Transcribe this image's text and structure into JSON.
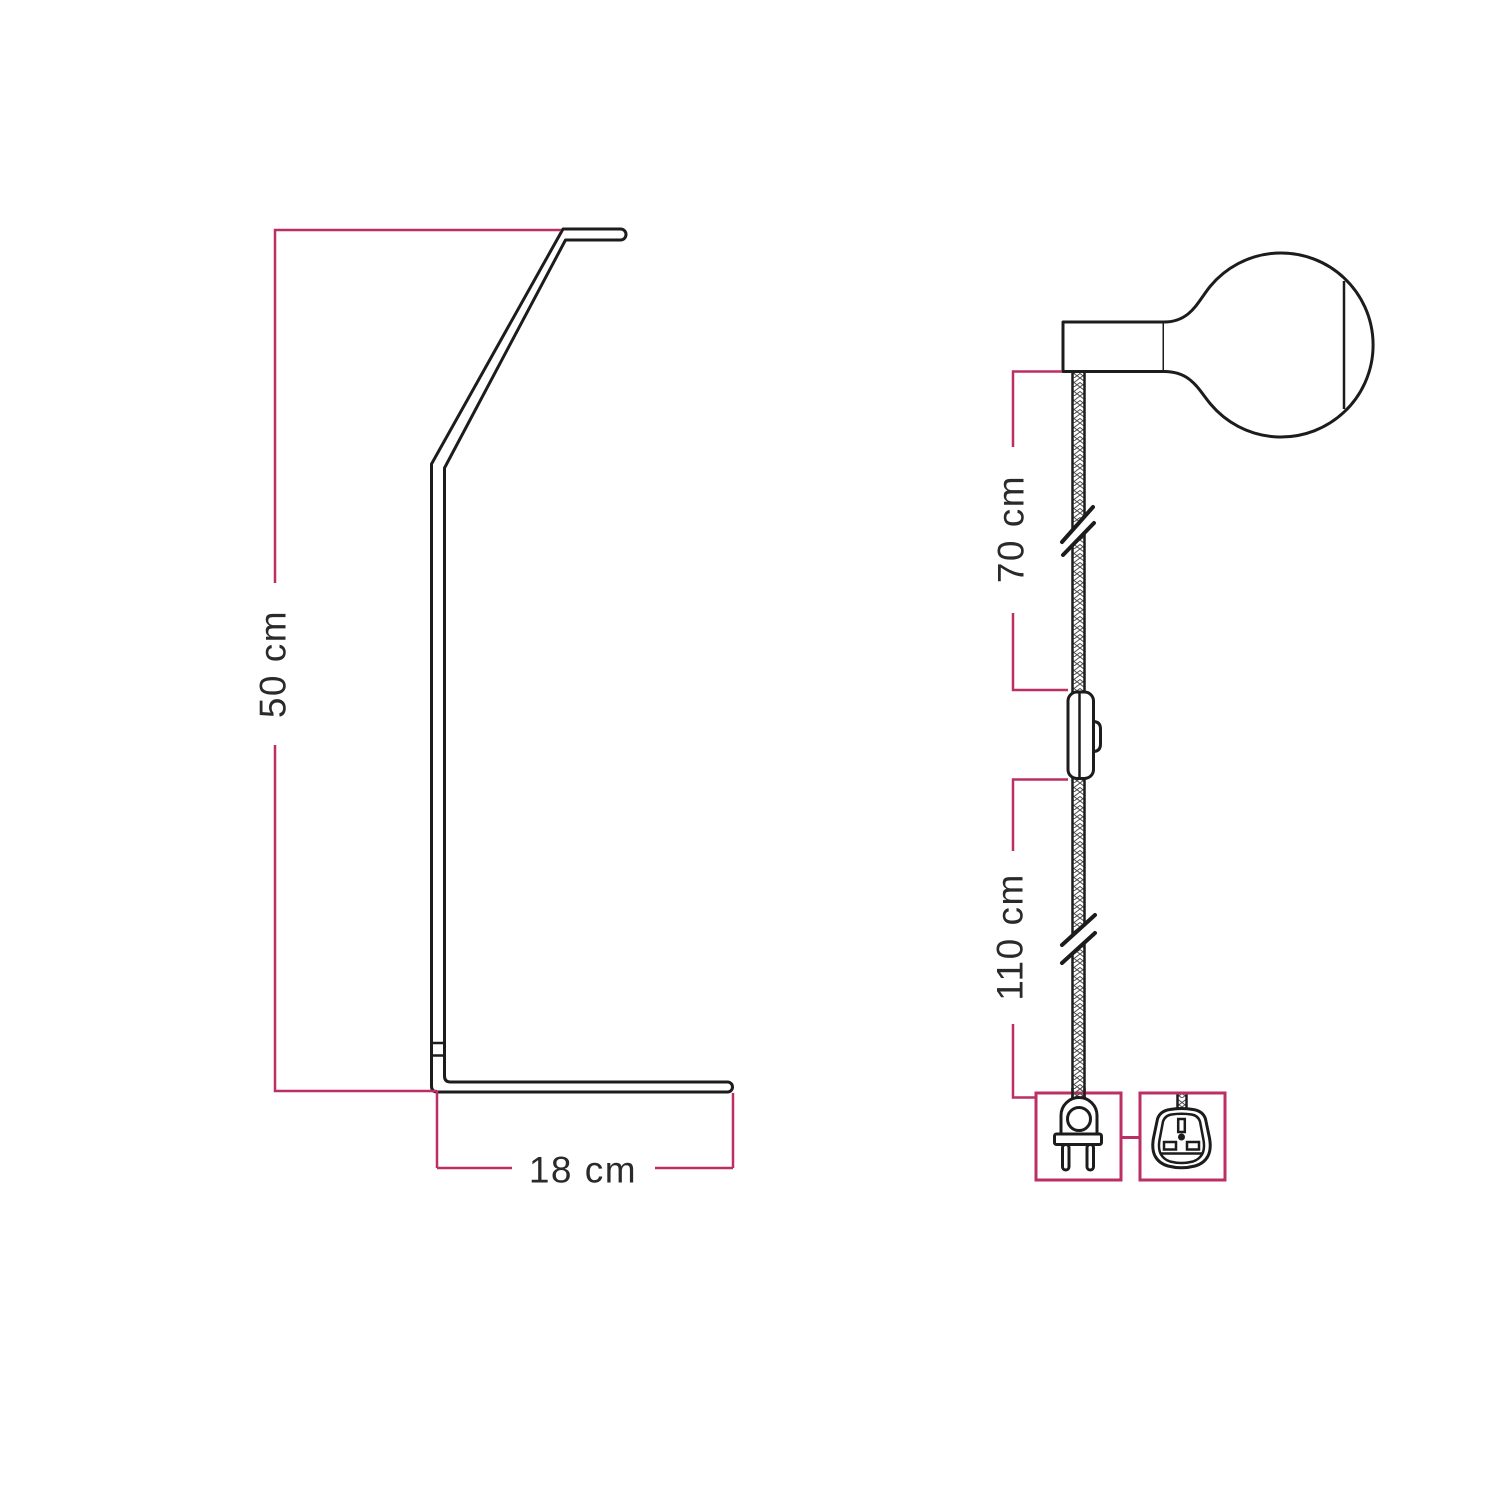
{
  "diagram": {
    "title": "Lamp dimensions technical drawing",
    "colors": {
      "background": "#ffffff",
      "line": "#1c1c1c",
      "dimension": "#bb2f63",
      "text": "#2a2a2a"
    },
    "stand_view": {
      "name": "stand-side-profile",
      "height_dimension": {
        "label": "50 cm"
      },
      "base_dimension": {
        "label": "18 cm"
      }
    },
    "pendant_view": {
      "name": "cable-with-bulb-switch-and-plug",
      "upper_cable_dimension": {
        "label": "70 cm"
      },
      "lower_cable_dimension": {
        "label": "110 cm"
      },
      "icons": [
        {
          "name": "bulb-icon"
        },
        {
          "name": "lamp-holder-icon"
        },
        {
          "name": "inline-switch-icon"
        },
        {
          "name": "cable-break-icon"
        },
        {
          "name": "euro-two-pin-plug-icon"
        },
        {
          "name": "uk-plug-adapter-icon"
        }
      ]
    }
  }
}
